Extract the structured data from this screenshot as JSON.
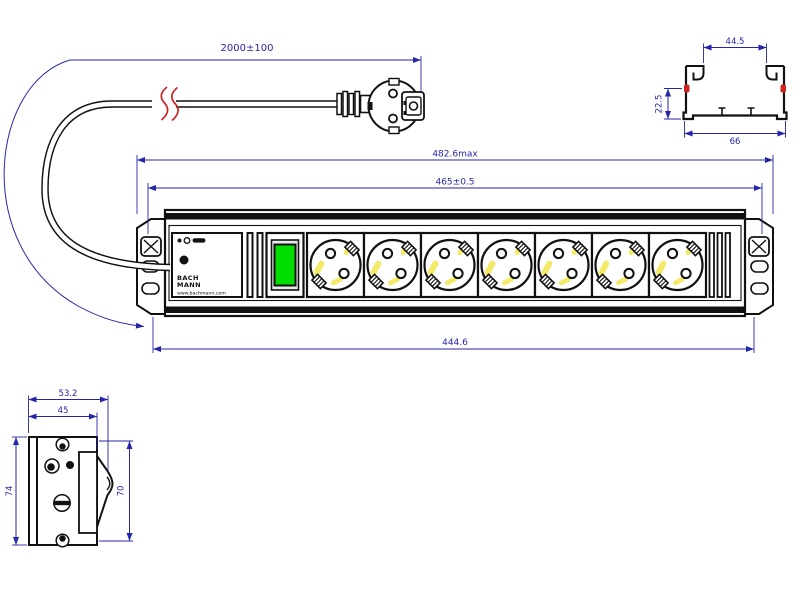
{
  "drawing": {
    "type": "technical dimension drawing",
    "subject": "19-inch power distribution strip with 7 Schuko sockets, switch, power cord and plug"
  },
  "colors": {
    "outline": "#111111",
    "dimension_lines": "#2626aa",
    "break_mark_red": "#cc2222",
    "switch_green": "#00dd00",
    "socket_highlight_yellow": "#f3ea67"
  },
  "views": {
    "cable": {
      "length_dim": "2000±100"
    },
    "profile_section": {
      "width_top": "44.5",
      "height": "22.5",
      "width_bottom": "66"
    },
    "front": {
      "overall_length": "482.6max",
      "mounting_distance": "465±0.5",
      "housing_length": "444.6",
      "socket_count": 7,
      "label": {
        "brand_line1": "BACH",
        "brand_line2": "MANN",
        "website": "www.bachmann.com"
      }
    },
    "side": {
      "depth_overall": "53.2",
      "depth_inner": "45",
      "height_left": "74",
      "height_right": "70"
    }
  }
}
